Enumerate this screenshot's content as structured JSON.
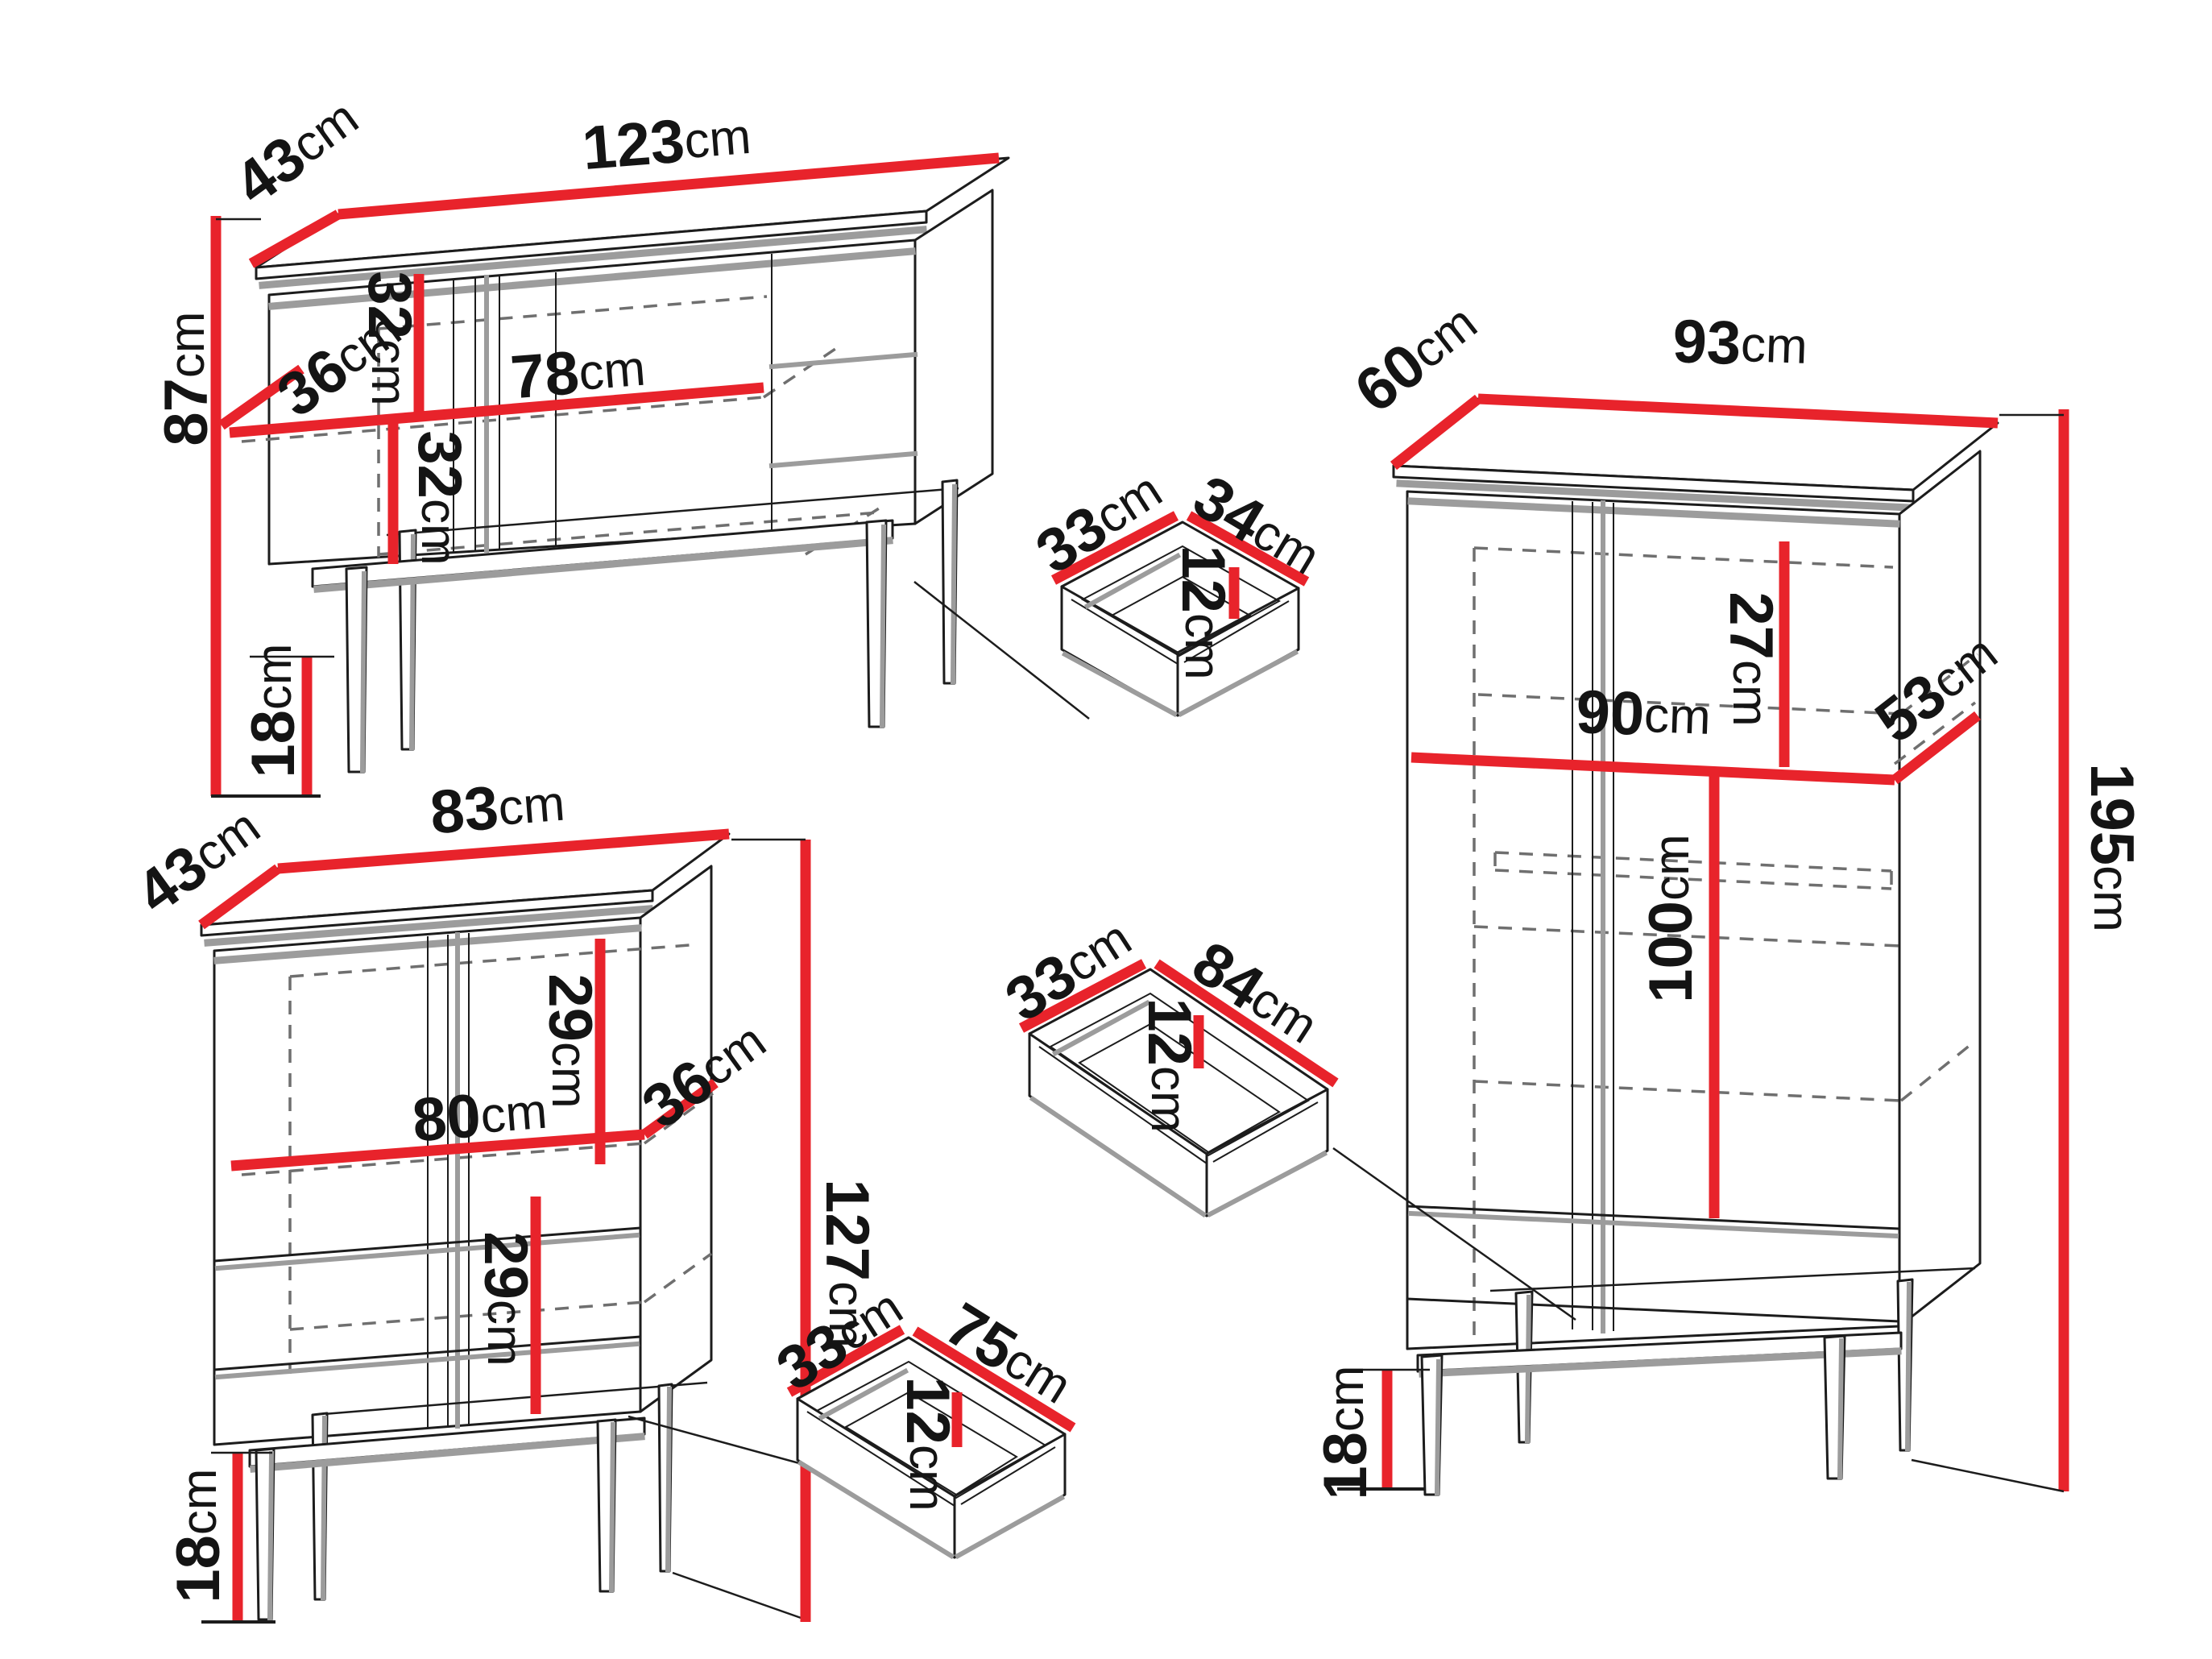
{
  "colors": {
    "dimension_red": "#e8232b",
    "outline_black": "#1c1c1c",
    "shadow_gray": "#9c9c9c",
    "hidden_line_gray": "#6f6f6f",
    "background": "#ffffff"
  },
  "labels": {
    "sideboard": {
      "width": {
        "v": "123",
        "u": "cm"
      },
      "depth": {
        "v": "43",
        "u": "cm"
      },
      "height": {
        "v": "87",
        "u": "cm"
      },
      "upper_inner": {
        "v": "32",
        "u": "cm"
      },
      "shelf_depth": {
        "v": "36",
        "u": "cm"
      },
      "shelf_width": {
        "v": "78",
        "u": "cm"
      },
      "lower_inner": {
        "v": "32",
        "u": "cm"
      },
      "legs": {
        "v": "18",
        "u": "cm"
      }
    },
    "highboard": {
      "width": {
        "v": "83",
        "u": "cm"
      },
      "depth": {
        "v": "43",
        "u": "cm"
      },
      "upper_inner": {
        "v": "29",
        "u": "cm"
      },
      "shelf_width": {
        "v": "80",
        "u": "cm"
      },
      "shelf_depth": {
        "v": "36",
        "u": "cm"
      },
      "lower_inner": {
        "v": "29",
        "u": "cm"
      },
      "height": {
        "v": "127",
        "u": "cm"
      },
      "legs": {
        "v": "18",
        "u": "cm"
      }
    },
    "wardrobe": {
      "width": {
        "v": "93",
        "u": "cm"
      },
      "depth": {
        "v": "60",
        "u": "cm"
      },
      "top_inner": {
        "v": "27",
        "u": "cm"
      },
      "inner_width": {
        "v": "90",
        "u": "cm"
      },
      "inner_depth": {
        "v": "53",
        "u": "cm"
      },
      "hanging": {
        "v": "100",
        "u": "cm"
      },
      "height": {
        "v": "195",
        "u": "cm"
      },
      "legs": {
        "v": "18",
        "u": "cm"
      }
    },
    "drawer_small": {
      "depth": {
        "v": "33",
        "u": "cm"
      },
      "width": {
        "v": "34",
        "u": "cm"
      },
      "height": {
        "v": "12",
        "u": "cm"
      }
    },
    "drawer_medium": {
      "depth": {
        "v": "33",
        "u": "cm"
      },
      "width": {
        "v": "84",
        "u": "cm"
      },
      "height": {
        "v": "12",
        "u": "cm"
      }
    },
    "drawer_large": {
      "depth": {
        "v": "33",
        "u": "cm"
      },
      "width": {
        "v": "75",
        "u": "cm"
      },
      "height": {
        "v": "12",
        "u": "cm"
      }
    }
  }
}
